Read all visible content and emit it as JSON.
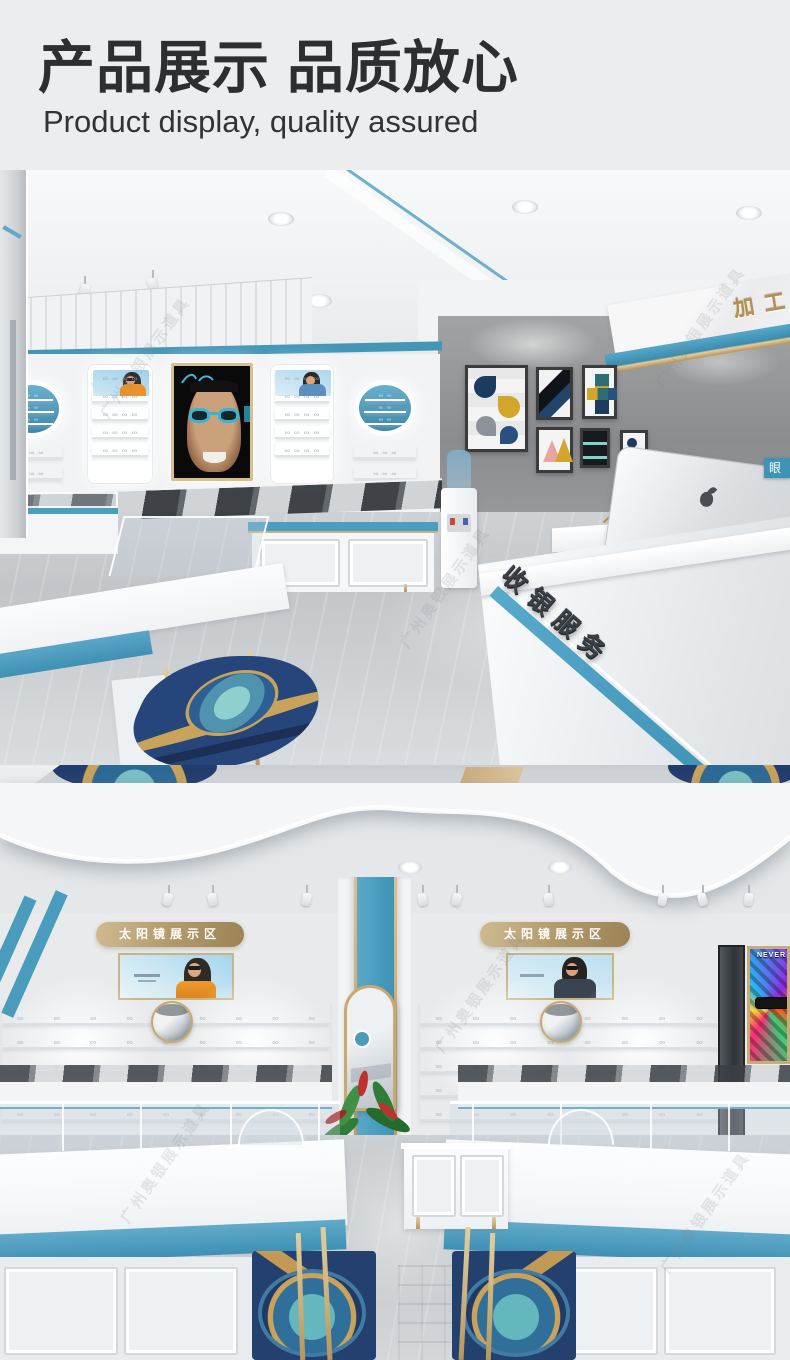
{
  "header": {
    "title": "产品展示 品质放心",
    "subtitle": "Product display, quality assured"
  },
  "photo1": {
    "processing_sign": "加工",
    "cashier_sign": "收银服务",
    "eyewear_tag": "眼"
  },
  "photo2": {
    "sunglasses_zone_left": "太阳镜展示区",
    "sunglasses_zone_right": "太阳镜展示区",
    "art_poster_word": "NEVER"
  },
  "watermark": {
    "text": "广州奥银展示道具"
  },
  "colors": {
    "teal_accent": "#4a9ec0",
    "gold_accent": "#c3a874",
    "title_text": "#2d2e2f",
    "concrete_wall": "#97999b",
    "navy_rug": "#24406f"
  }
}
